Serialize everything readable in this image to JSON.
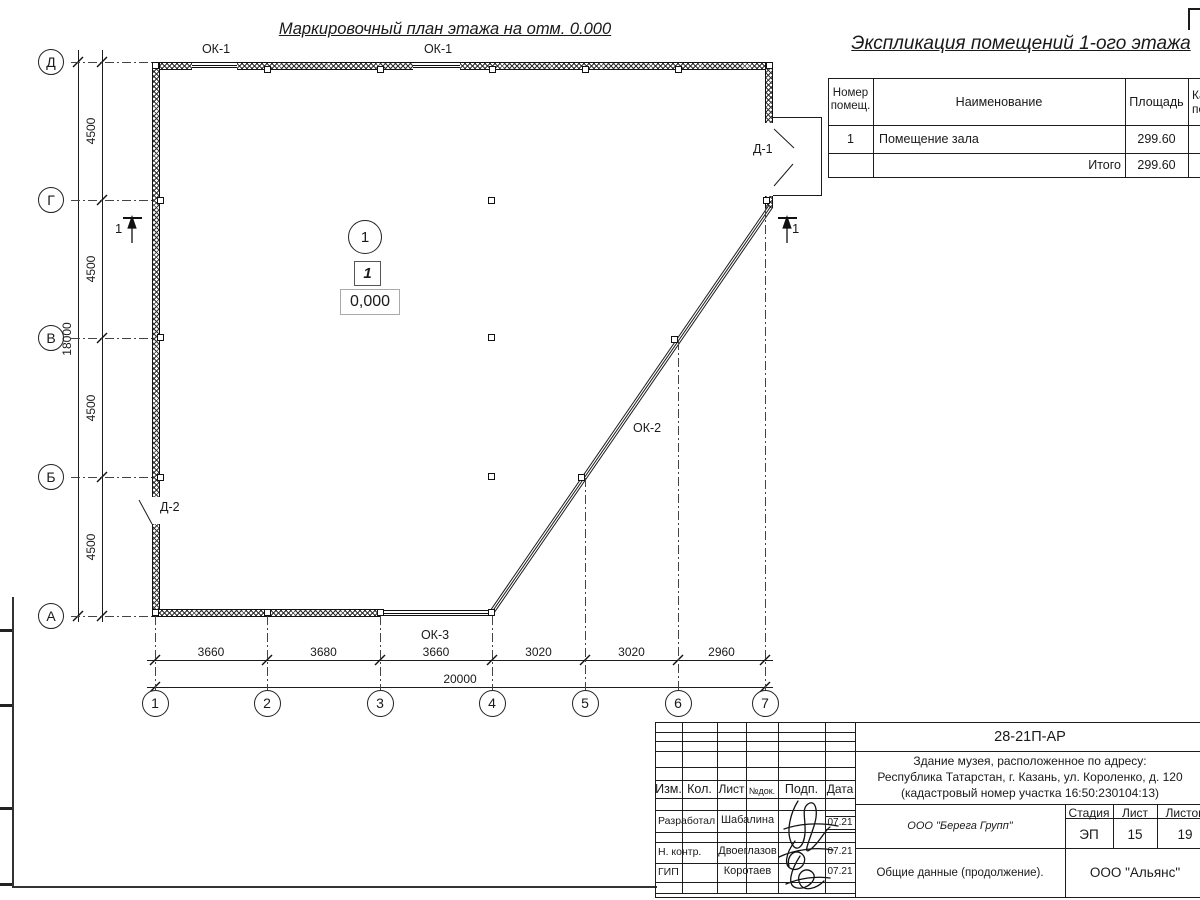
{
  "titles": {
    "plan": "Маркировочный план этажа на отм. 0.000",
    "explication": "Экспликация помещений 1-ого этажа"
  },
  "explication": {
    "headers": {
      "number_line1": "Номер",
      "number_line2": "помещ.",
      "name": "Наименование",
      "area": "Площадь",
      "extra_line1": "Ка",
      "extra_line2": "по"
    },
    "rows": [
      {
        "number": "1",
        "name": "Помещение зала",
        "area": "299.60"
      }
    ],
    "total_label": "Итого",
    "total_area": "299.60"
  },
  "axes": {
    "vertical": [
      "Д",
      "Г",
      "В",
      "Б",
      "А"
    ],
    "horizontal": [
      "1",
      "2",
      "3",
      "4",
      "5",
      "6",
      "7"
    ]
  },
  "dimensions": {
    "vertical_segments": [
      "4500",
      "4500",
      "4500",
      "4500"
    ],
    "vertical_total": "18000",
    "horizontal_segments": [
      "3660",
      "3680",
      "3660",
      "3020",
      "3020",
      "2960"
    ],
    "horizontal_total": "20000"
  },
  "plan_labels": {
    "ok1a": "ОК-1",
    "ok1b": "ОК-1",
    "ok2": "ОК-2",
    "ok3": "ОК-3",
    "d1": "Д-1",
    "d2": "Д-2",
    "room_number_circle": "1",
    "room_number_box": "1",
    "elevation": "0,000",
    "section_left": "1",
    "section_right": "1"
  },
  "title_block": {
    "doc_code": "28-21П-АР",
    "address_line1": "Здание музея, расположенное по адресу:",
    "address_line2": "Республика Татарстан, г. Казань, ул. Короленко, д. 120",
    "address_line3": "(кадастровый номер участка 16:50:230104:13)",
    "cols": {
      "izm": "Изм.",
      "kol": "Кол.",
      "list": "Лист",
      "ndoc": "№док.",
      "podp": "Подп.",
      "data": "Дата"
    },
    "rows": [
      {
        "role": "Разработал",
        "name": "Шабалина",
        "date": "07.21"
      },
      {
        "role": "Н. контр.",
        "name": "Двоеглазов",
        "date": "07.21"
      },
      {
        "role": "ГИП",
        "name": "Коротаев",
        "date": "07.21"
      }
    ],
    "org_designer": "ООО \"Берега Групп\"",
    "stage_label": "Стадия",
    "sheet_label": "Лист",
    "sheets_label": "Листов",
    "stage": "ЭП",
    "sheet": "15",
    "sheets": "19",
    "doc_title": "Общие данные (продолжение).",
    "org": "ООО \"Альянс\""
  },
  "colors": {
    "line": "#1c1c1c",
    "paper": "#ffffff"
  }
}
